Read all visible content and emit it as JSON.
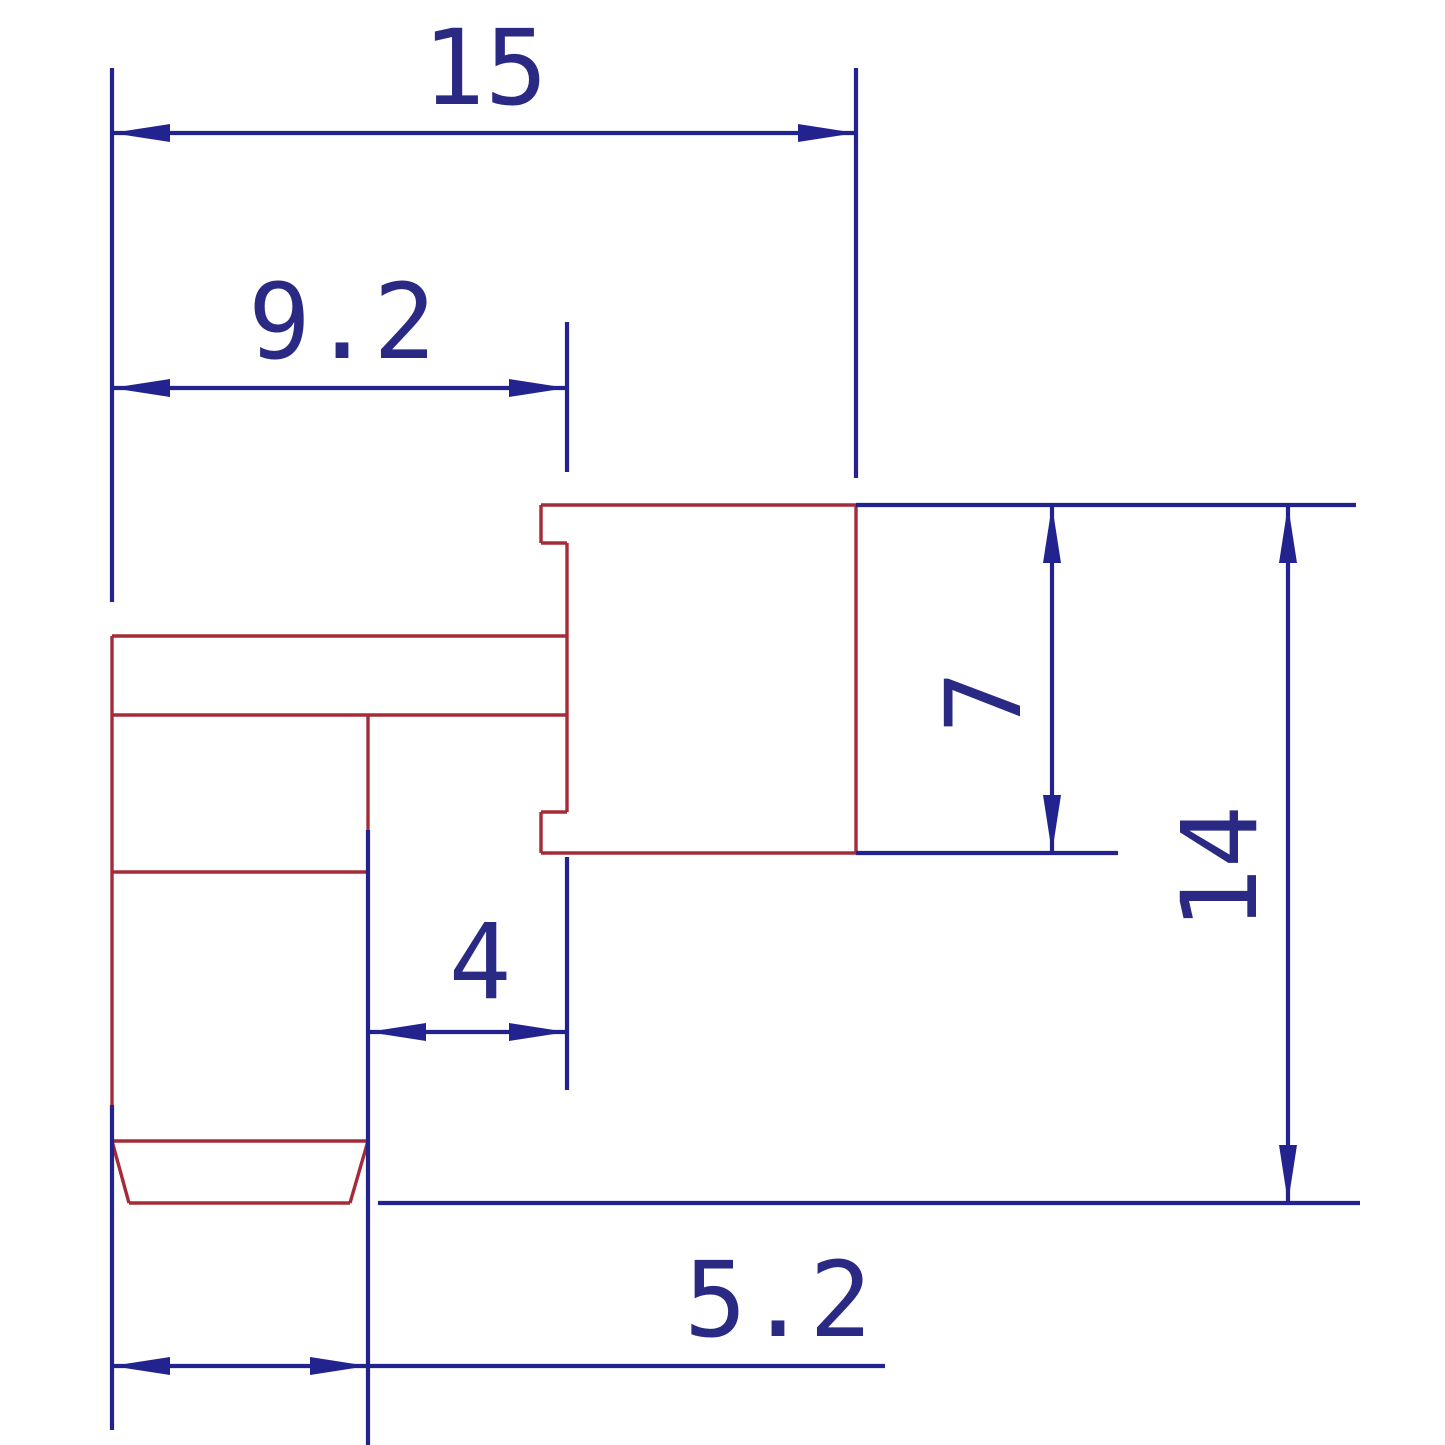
{
  "drawing": {
    "kind": "2D CAD dimensioned part drawing (side view, two mating bodies)",
    "colors": {
      "part_outline": "#a62b38",
      "dimension_blue": "#23238f",
      "text_navy": "#2a2a85",
      "background": "#ffffff"
    },
    "dims": {
      "d15": {
        "label": "15",
        "meaning": "overall width, left edge to right body right edge"
      },
      "d9_2": {
        "label": "9.2",
        "meaning": "width from left edge to right-body left edge"
      },
      "d4": {
        "label": "4",
        "meaning": "width from lower-body right edge to right-body left edge"
      },
      "d5_2": {
        "label": "5.2",
        "meaning": "lower body width"
      },
      "d7": {
        "label": "7",
        "meaning": "right body height"
      },
      "d14": {
        "label": "14",
        "meaning": "overall height, top of right body to part bottom"
      }
    }
  }
}
